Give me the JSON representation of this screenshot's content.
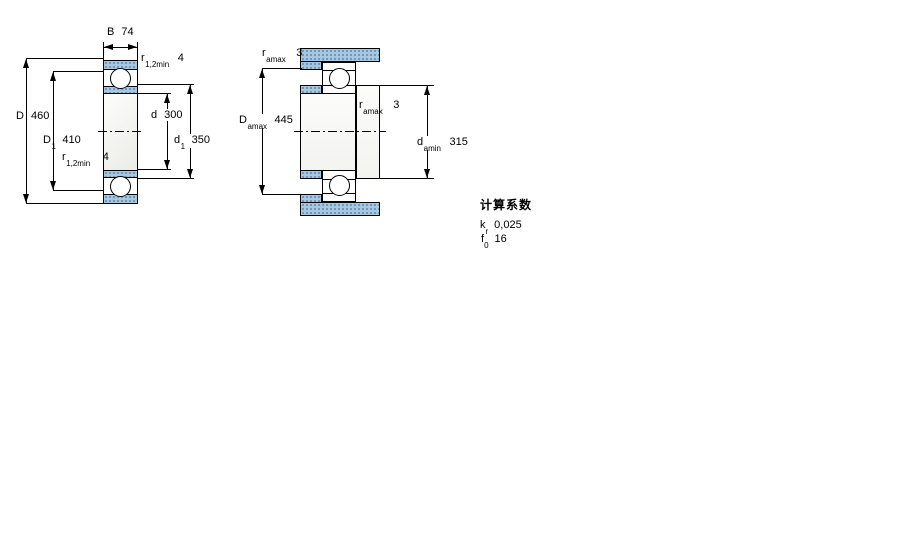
{
  "colors": {
    "hatch_fill": "#a7c8e2",
    "hatch_dot": "#23466e",
    "line": "#000000",
    "background": "#ffffff"
  },
  "left_drawing": {
    "description": "bearing-cross-section",
    "B": {
      "symbol": "B",
      "value": "74"
    },
    "r12_top": {
      "symbol": "r",
      "subscript": "1,2min",
      "value": "4"
    },
    "D": {
      "symbol": "D",
      "value": "460"
    },
    "D1": {
      "symbol": "D",
      "subscript": "1",
      "value": "410"
    },
    "d": {
      "symbol": "d",
      "value": "300"
    },
    "d1": {
      "symbol": "d",
      "subscript": "1",
      "value": "350"
    },
    "r12_bottom": {
      "symbol": "r",
      "subscript": "1,2min",
      "value": "4"
    }
  },
  "right_drawing": {
    "description": "bearing-mounting-dimensions",
    "ra_top": {
      "symbol": "r",
      "subscript": "amax",
      "value": "3"
    },
    "Da": {
      "symbol": "D",
      "subscript": "amax",
      "value": "445"
    },
    "ra_mid": {
      "symbol": "r",
      "subscript": "amax",
      "value": "3"
    },
    "da": {
      "symbol": "d",
      "subscript": "amin",
      "value": "315"
    }
  },
  "calculation_factors": {
    "heading": "计算系数",
    "factors": [
      {
        "symbol": "k",
        "subscript": "r",
        "value": "0,025"
      },
      {
        "symbol": "f",
        "subscript": "0",
        "value": "16"
      }
    ]
  }
}
